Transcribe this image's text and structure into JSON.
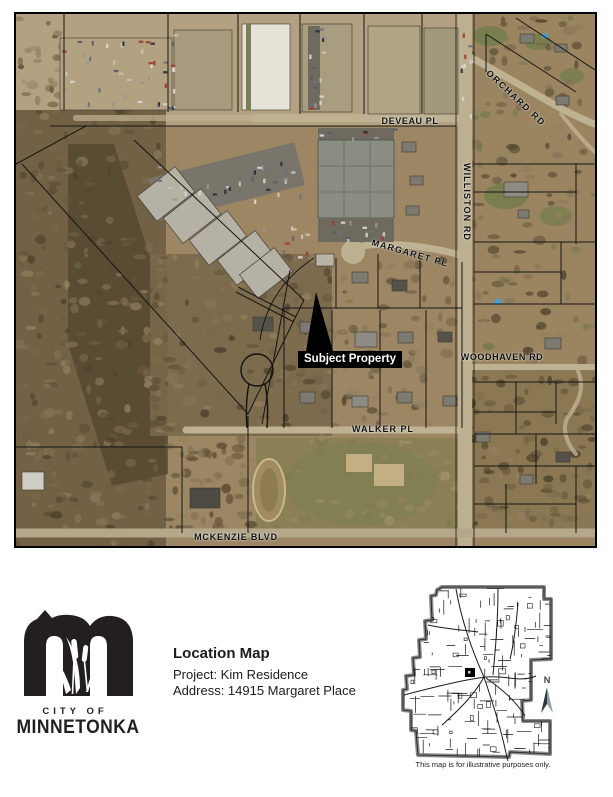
{
  "map": {
    "street_labels": {
      "deveau": "DEVEAU PL",
      "orchard": "ORCHARD RD",
      "williston": "WILLISTON RD",
      "margaret": "MARGARET PL",
      "woodhaven": "WOODHAVEN RD",
      "walker": "WALKER PL",
      "mckenzie": "MCKENZIE BLVD"
    },
    "subject_property": "Subject Property"
  },
  "footer": {
    "logo": {
      "city_of": "CITY OF",
      "city_name": "MINNETONKA"
    },
    "title": "Location Map",
    "project_line": "Project: Kim Residence",
    "address_line": "Address: 14915 Margaret Place"
  },
  "inset": {
    "north_label": "N",
    "caption": "This map is for illustrative purposes only."
  },
  "colors": {
    "subject_label_bg": "#000000",
    "subject_label_fg": "#ffffff",
    "logo_ink": "#231f20",
    "aerial_base": "#9c8663"
  }
}
